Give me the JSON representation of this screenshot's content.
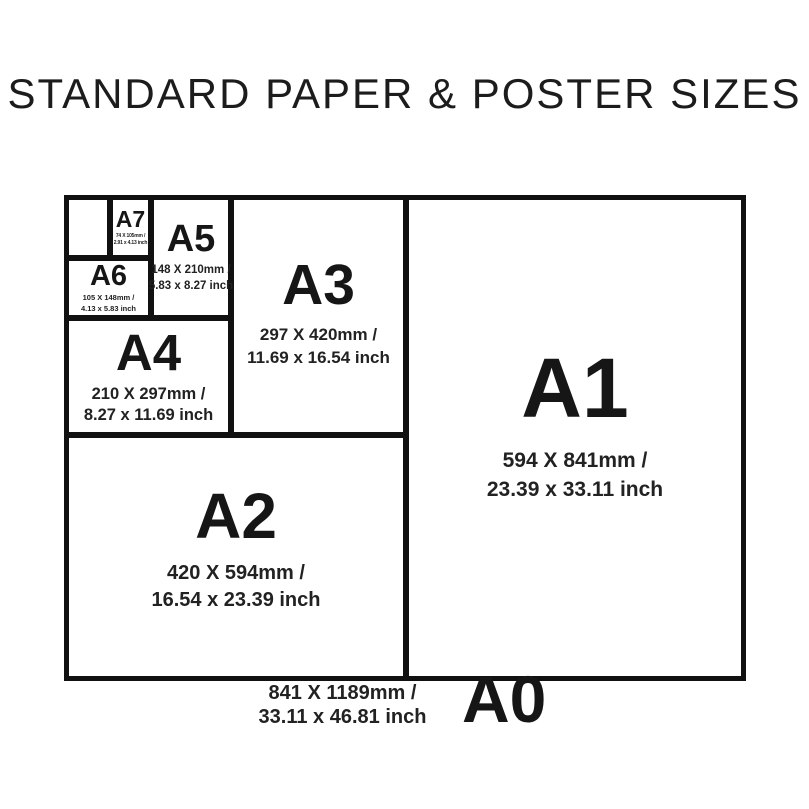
{
  "title": "STANDARD PAPER & POSTER SIZES",
  "colors": {
    "ink": "#111111",
    "text": "#1a1a1a",
    "background": "#ffffff"
  },
  "sizes": [
    {
      "id": "a0",
      "label": "A0",
      "mm": "841 X 1189mm /",
      "inch": "33.11 x 46.81 inch"
    },
    {
      "id": "a1",
      "label": "A1",
      "mm": "594 X 841mm /",
      "inch": "23.39 x 33.11 inch"
    },
    {
      "id": "a2",
      "label": "A2",
      "mm": "420 X 594mm /",
      "inch": "16.54 x 23.39 inch"
    },
    {
      "id": "a3",
      "label": "A3",
      "mm": "297 X 420mm /",
      "inch": "11.69 x 16.54 inch"
    },
    {
      "id": "a4",
      "label": "A4",
      "mm": "210 X 297mm /",
      "inch": "8.27 x 11.69 inch"
    },
    {
      "id": "a5",
      "label": "A5",
      "mm": "148 X 210mm /",
      "inch": "5.83 x 8.27 inch"
    },
    {
      "id": "a6",
      "label": "A6",
      "mm": "105 X 148mm /",
      "inch": "4.13 x 5.83 inch"
    },
    {
      "id": "a7",
      "label": "A7",
      "mm": "74 X 105mm /",
      "inch": "2.91 x 4.13 inch"
    }
  ]
}
